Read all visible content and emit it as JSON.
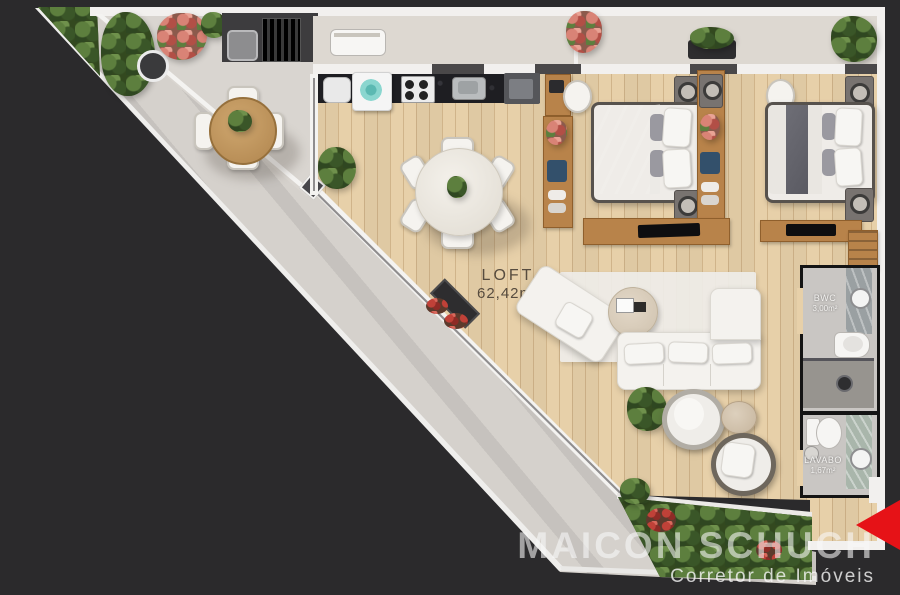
{
  "canvas": {
    "width": 900,
    "height": 595,
    "background": "#2b2a2c"
  },
  "floor_plan": {
    "type": "rendered-top-view-apartment-plan",
    "rooms": [
      {
        "id": "loft",
        "label": "LOFT",
        "area": "62,42m²"
      },
      {
        "id": "bwc",
        "label": "BWC",
        "area": "3,00m²"
      },
      {
        "id": "lavabo",
        "label": "LAVABO",
        "area": "1,67m²"
      }
    ],
    "areas": {
      "terrace": {
        "furniture": [
          "hedge",
          "potted-plants",
          "coral-flower-plant",
          "grill-counter",
          "grill-sink",
          "round-wood-table",
          "four-chairs"
        ]
      },
      "balcony": {
        "furniture": [
          "bench",
          "flower-vase",
          "planter-boxes",
          "potted-plant"
        ]
      },
      "kitchen": {
        "furniture": [
          "laundry-sink",
          "washing-machine",
          "cooktop",
          "steel-sink",
          "cabinet"
        ]
      },
      "bedroom_1": {
        "furniture": [
          "desk-with-laptop",
          "desk-chair",
          "wardrobe-shelves",
          "double-bed-dark-duvet",
          "nightstands-with-lamps",
          "tv-console"
        ]
      },
      "bedroom_2": {
        "furniture": [
          "desk-chair",
          "wardrobe-shelves",
          "double-bed-white-duvet",
          "nightstands-with-lamps",
          "tv-console",
          "bookshelf"
        ]
      },
      "dining": {
        "furniture": [
          "round-table",
          "six-chairs",
          "centerpiece-plant"
        ]
      },
      "living": {
        "furniture": [
          "rug",
          "chaise-lounge",
          "round-coffee-table",
          "l-shaped-sofa",
          "two-round-armchairs",
          "pouf",
          "plant"
        ]
      },
      "bwc": {
        "furniture": [
          "vanity-sink",
          "toilet",
          "shower"
        ]
      },
      "lavabo": {
        "furniture": [
          "toilet",
          "counter-sink"
        ]
      },
      "bottom_planter": {
        "furniture": [
          "dense-greenery",
          "red-flowers"
        ]
      }
    }
  },
  "watermark": {
    "title": "MAICON SCHUCH",
    "subtitle": "Corretor de Imóveis"
  },
  "nav": {
    "prev_arrow": "left-triangle"
  },
  "colors": {
    "background": "#2b2a2c",
    "wood_floor": "#e7d0a9",
    "terrace_floor": "#d9d5d0",
    "walkway": "#d5d1cc",
    "wall_white": "#f2f0ee",
    "counter_black": "#1e1e22",
    "wood_furniture": "#b8834a",
    "greenery": "#33491f",
    "accent_red": "#e61217",
    "label_dark": "#574c3f",
    "label_light": "#f3f2f0"
  }
}
